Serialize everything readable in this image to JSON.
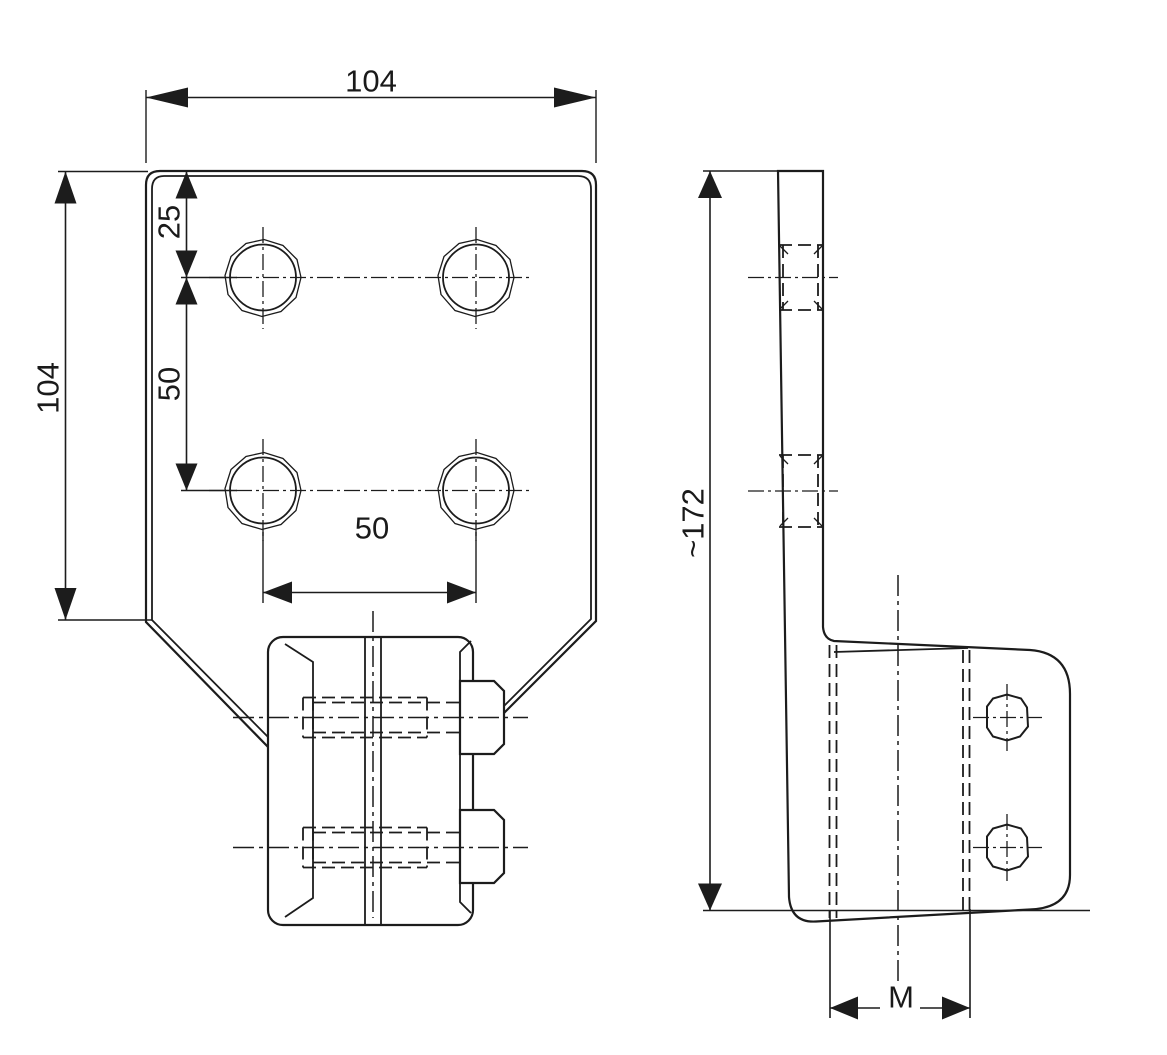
{
  "drawing": {
    "kind": "technical-drawing-two-views",
    "ink_color": "#1c1c1c",
    "background": "#ffffff",
    "dims": {
      "front_width": "104",
      "front_height": "104",
      "hole_offset_top": "25",
      "hole_spacing_vertical": "50",
      "hole_spacing_horizontal": "50",
      "side_height": "~172",
      "jaw_width": "M"
    }
  }
}
